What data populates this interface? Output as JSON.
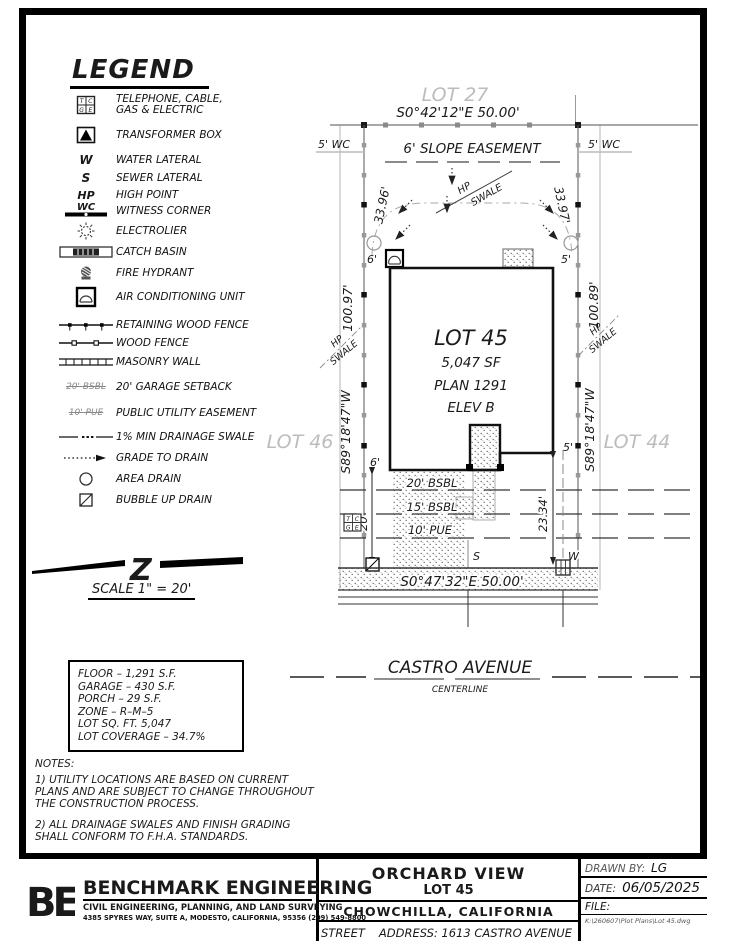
{
  "legend": {
    "title": "LEGEND",
    "tcge": [
      "T",
      "C",
      "G",
      "E"
    ],
    "items": [
      {
        "label": "TELEPHONE, CABLE,\nGAS & ELECTRIC"
      },
      {
        "label": "TRANSFORMER BOX"
      },
      {
        "symbol": "W",
        "label": "WATER LATERAL"
      },
      {
        "symbol": "S",
        "label": "SEWER LATERAL"
      },
      {
        "symbol": "HP",
        "label": "HIGH POINT"
      },
      {
        "symbol": "WC",
        "label": "WITNESS CORNER"
      },
      {
        "label": "ELECTROLIER"
      },
      {
        "label": "CATCH BASIN"
      },
      {
        "label": "FIRE HYDRANT"
      },
      {
        "label": "AIR CONDITIONING UNIT"
      },
      {
        "label": "RETAINING WOOD FENCE"
      },
      {
        "label": "WOOD FENCE"
      },
      {
        "label": "MASONRY WALL"
      },
      {
        "symbol": "20' BSBL",
        "label": "20' GARAGE SETBACK"
      },
      {
        "symbol": "10' PUE",
        "label": "PUBLIC UTILITY EASEMENT"
      },
      {
        "label": "1% MIN DRAINAGE SWALE"
      },
      {
        "label": "GRADE TO DRAIN"
      },
      {
        "label": "AREA DRAIN"
      },
      {
        "label": "BUBBLE UP DRAIN"
      }
    ]
  },
  "scale": {
    "label": "SCALE  1\" = 20'",
    "mark": "Z"
  },
  "stats": {
    "lines": [
      "FLOOR  –  1,291  S.F.",
      "GARAGE  –  430  S.F.",
      "PORCH  –  29  S.F.",
      "ZONE  –  R–M–5",
      "LOT  SQ.  FT.  5,047",
      "LOT  COVERAGE  –  34.7%"
    ]
  },
  "notes": {
    "title": "NOTES:",
    "note1": "1) UTILITY LOCATIONS ARE BASED ON CURRENT PLANS AND ARE SUBJECT TO CHANGE THROUGHOUT THE CONSTRUCTION PROCESS.",
    "note2": "2) ALL DRAINAGE SWALES AND FINISH GRADING SHALL CONFORM TO F.H.A. STANDARDS."
  },
  "plan": {
    "lot27": "LOT 27",
    "lot46": "LOT 46",
    "lot44": "LOT 44",
    "bearing_top": "S0°42'12\"E   50.00'",
    "slope_easement": "6'  SLOPE  EASEMENT",
    "wc_left": "5' WC",
    "wc_right": "5' WC",
    "diag_left": "33.96'",
    "diag_right": "33.97'",
    "hp": "HP",
    "swale": "SWALE",
    "house_name": "LOT 45",
    "house_sf": "5,047 SF",
    "house_plan": "PLAN 1291",
    "house_elev": "ELEV B",
    "dist_left": "100.97'",
    "bearing_left": "S89°18'47\"W",
    "dist_right": "100.89'",
    "bearing_right": "S89°18'47\"W",
    "dim_6_top": "6'",
    "dim_5_top": "5'",
    "dim_6_bot": "6'",
    "dim_5_bot": "5'",
    "dim_20": "20'",
    "dim_2334": "23.34'",
    "setback20": "20' BSBL",
    "setback15": "15' BSBL",
    "pue10": "10' PUE",
    "sewer": "S",
    "water": "W",
    "bearing_bottom": "S0°47'32\"E   50.00'",
    "street_name": "CASTRO  AVENUE",
    "centerline": "CENTERLINE"
  },
  "titleblock": {
    "logo": "BE",
    "company": "BENCHMARK ENGINEERING",
    "company_sub": "CIVIL ENGINEERING, PLANNING, AND LAND SURVEYING",
    "company_addr": "4385 SPYRES WAY, SUITE A, MODESTO, CALIFORNIA, 95356    (209) 549-8800",
    "project": "ORCHARD  VIEW",
    "lot": "LOT 45",
    "city": "CHOWCHILLA,    CALIFORNIA",
    "street_label": "STREET",
    "address_value": "ADDRESS:  1613  CASTRO  AVENUE",
    "drawn_by_label": "DRAWN  BY:",
    "drawn_by": "LG",
    "date_label": "DATE:",
    "date": "06/05/2025",
    "file_label": "FILE:",
    "file_path": "K:\\260607\\Plot Plans\\Lot 45.dwg"
  }
}
